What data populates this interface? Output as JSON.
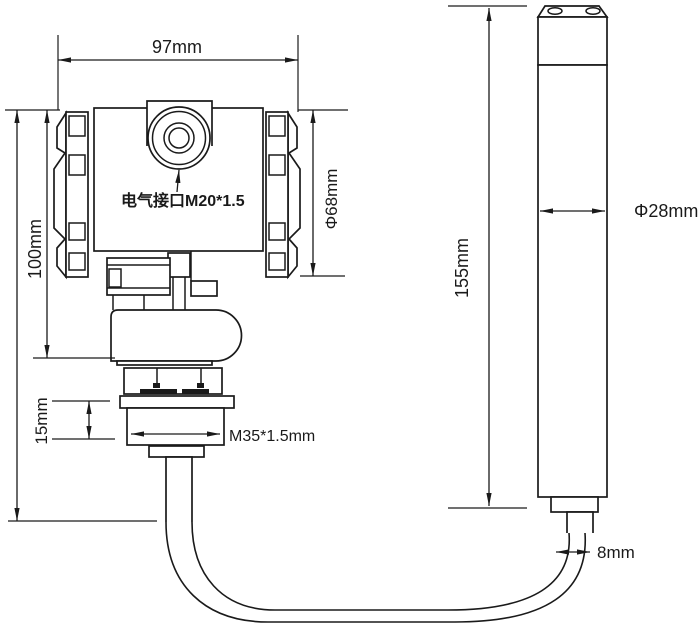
{
  "drawing": {
    "labels": {
      "head_width": "97mm",
      "head_height": "100mm",
      "electrical_port": "电气接口M20*1.5",
      "head_diameter": "Φ68mm",
      "thread_height": "15mm",
      "thread_spec": "M35*1.5mm",
      "probe_length": "155mm",
      "probe_diameter": "Φ28mm",
      "cable_diameter": "8mm"
    },
    "colors": {
      "line": "#1a1a1a",
      "background": "#ffffff"
    }
  }
}
